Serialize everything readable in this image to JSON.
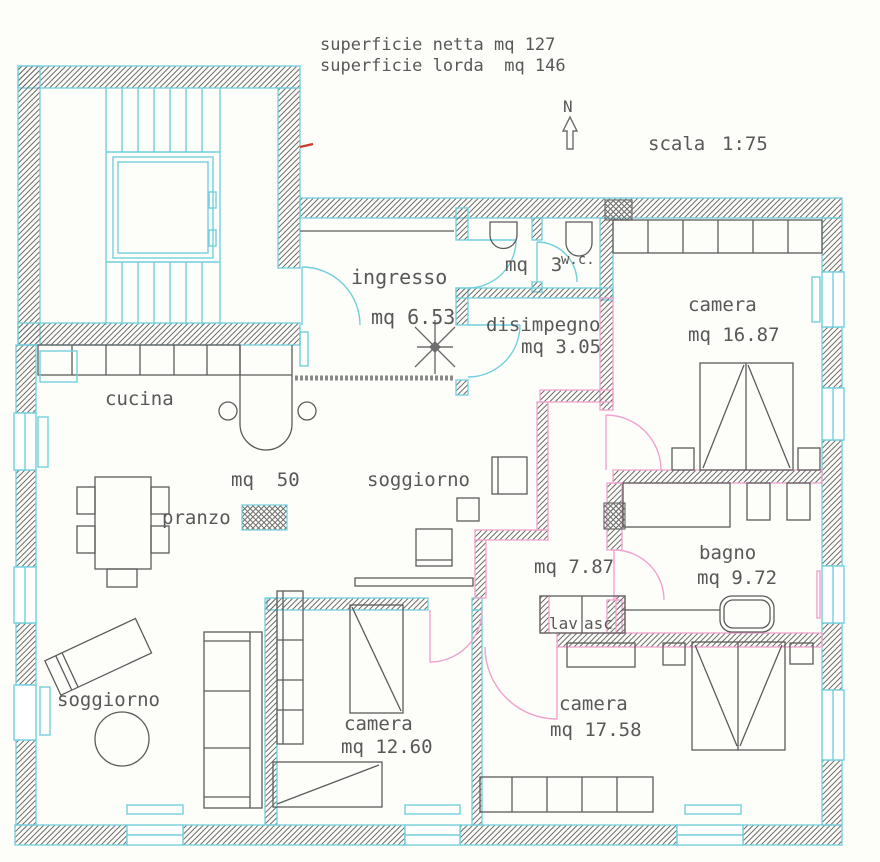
{
  "header": {
    "net_area": "superficie netta mq 127",
    "gross_area": "superficie lorda  mq 146"
  },
  "compass": {
    "north": "N"
  },
  "scale": {
    "label": "scala",
    "value": "1:75"
  },
  "rooms": {
    "ingresso": {
      "name": "ingresso",
      "area": "mq 6.53"
    },
    "wc": {
      "name": "w.c.",
      "area": "mq  3"
    },
    "disimpegno": {
      "name": "disimpegno",
      "area": "mq 3.05"
    },
    "camera_nord": {
      "name": "camera",
      "area": "mq 16.87"
    },
    "cucina": {
      "name": "cucina"
    },
    "pranzo": {
      "name": "pranzo"
    },
    "soggiorno": {
      "name": "soggiorno",
      "area": "mq  50"
    },
    "corridoio": {
      "area": "mq 7.87"
    },
    "bagno": {
      "name": "bagno",
      "area": "mq 9.72"
    },
    "lav": {
      "name": "lav"
    },
    "asc": {
      "name": "asc"
    },
    "soggiorno_sud": {
      "name": "soggiorno"
    },
    "camera_sud_ovest": {
      "name": "camera",
      "area": "mq 12.60"
    },
    "camera_sud_est": {
      "name": "camera",
      "area": "mq 17.58"
    }
  },
  "colors": {
    "wall-cyan": "#72cfdd",
    "partition-pink": "#f0a2ce",
    "hatch-gray": "#6e6e6e",
    "furniture-gray": "#5c5c5c",
    "text-gray": "#585858",
    "accent-red": "#cf3b30",
    "paper": "#fdfdfa"
  }
}
